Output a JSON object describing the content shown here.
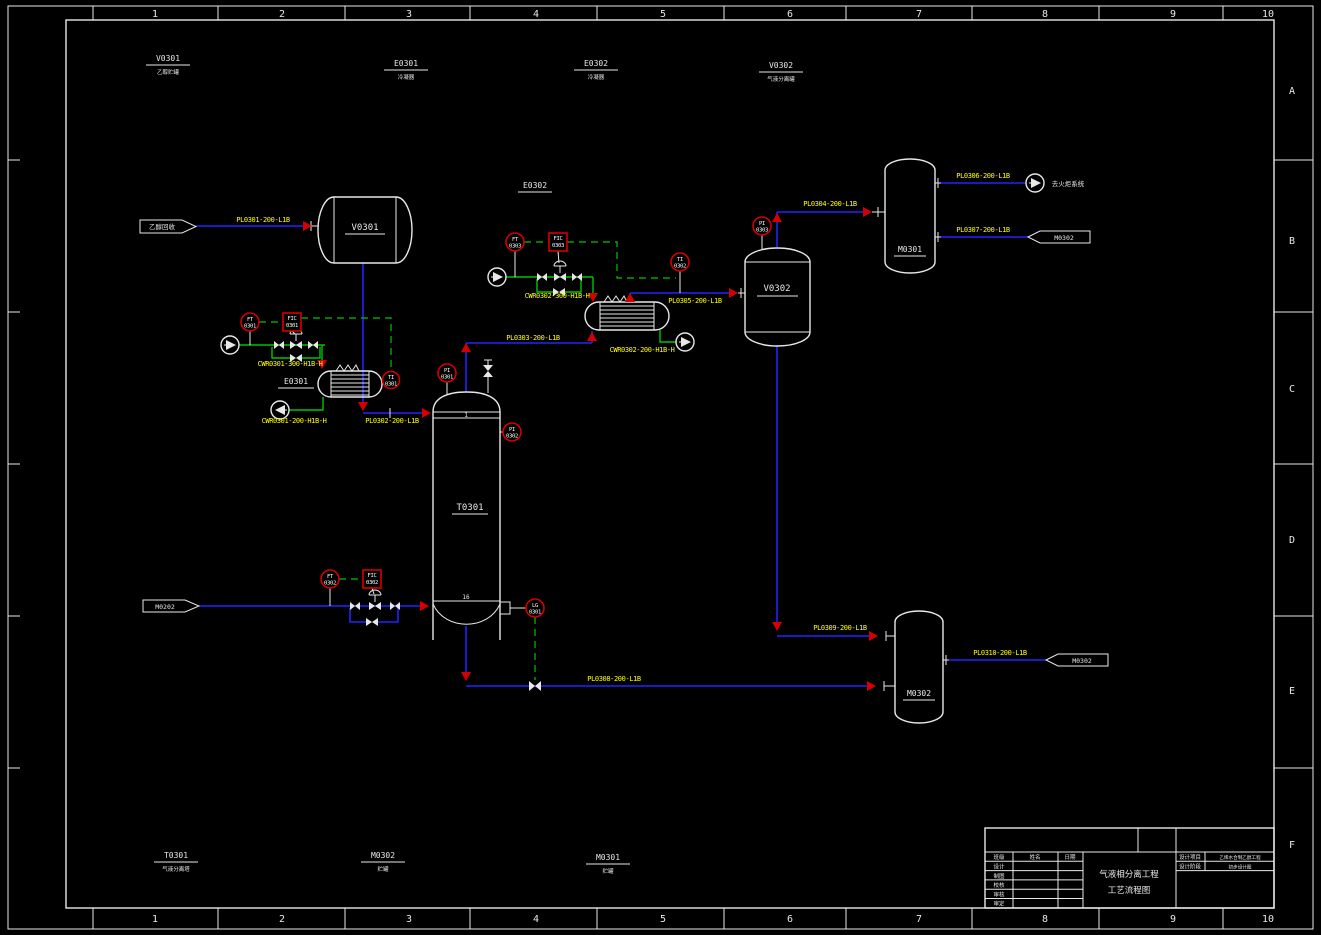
{
  "sheet": {
    "cols": [
      "1",
      "2",
      "3",
      "4",
      "5",
      "6",
      "7",
      "8",
      "9",
      "10"
    ],
    "rows": [
      "A",
      "B",
      "C",
      "D",
      "E",
      "F"
    ]
  },
  "colors": {
    "background": "#000000",
    "frame": "#e8e8e8",
    "process_line": "#2222ff",
    "utility_line": "#00c400",
    "pipe_label": "#ffff00",
    "instrument": "#d40000",
    "arrow": "#d40000"
  },
  "equipment": {
    "v0301": {
      "tag": "V0301",
      "name": "乙醇贮罐"
    },
    "e0301": {
      "tag": "E0301",
      "name": "冷凝器"
    },
    "e0302": {
      "tag": "E0302",
      "name": "冷凝器"
    },
    "v0302": {
      "tag": "V0302",
      "name": "气液分离罐"
    },
    "t0301": {
      "tag": "T0301",
      "name": "气液分离塔"
    },
    "m0301": {
      "tag": "M0301",
      "name": "贮罐"
    },
    "m0302": {
      "tag": "M0302",
      "name": "贮罐"
    }
  },
  "column": {
    "tray_top": "1",
    "tray_bottom": "16"
  },
  "connectors": {
    "feed_top": "乙醇回收",
    "feed_bottom": "M0202",
    "to_flare": "去火炬系统",
    "to_m0302_top": "M0302",
    "to_m0302_bottom": "M0302"
  },
  "pipes": {
    "pl0301": "PL0301-200-L1B",
    "pl0302": "PL0302-200-L1B",
    "pl0303": "PL0303-200-L1B",
    "pl0304": "PL0304-200-L1B",
    "pl0305": "PL0305-200-L1B",
    "pl0306": "PL0306-200-L1B",
    "pl0307": "PL0307-200-L1B",
    "pl0308": "PL0308-200-L1B",
    "pl0309": "PL0309-200-L1B",
    "pl0310": "PL0310-200-L1B",
    "cwr0301_supply": "CWR0301-300-H1B-H",
    "cwr0301_return": "CWR0301-200-H1B-H",
    "cwr0302_supply": "CWR0302-300-H1B-H",
    "cwr0302_return": "CWR0302-200-H1B-H"
  },
  "instruments": {
    "ft0301": {
      "line1": "FT",
      "line2": "0301"
    },
    "fic0301": {
      "line1": "FIC",
      "line2": "0301"
    },
    "ti0301": {
      "line1": "TI",
      "line2": "0301"
    },
    "ft0302": {
      "line1": "FT",
      "line2": "0302"
    },
    "fic0302": {
      "line1": "FIC",
      "line2": "0302"
    },
    "lg0301": {
      "line1": "LG",
      "line2": "0301"
    },
    "ft0303": {
      "line1": "FT",
      "line2": "0303"
    },
    "fic0303": {
      "line1": "FIC",
      "line2": "0303"
    },
    "ti0302": {
      "line1": "TI",
      "line2": "0302"
    },
    "pi0301": {
      "line1": "PI",
      "line2": "0301"
    },
    "pi0302": {
      "line1": "PI",
      "line2": "0302"
    },
    "pi0303": {
      "line1": "PI",
      "line2": "0303"
    }
  },
  "title_block": {
    "title_line1": "气液相分离工程",
    "title_line2": "工艺流程图",
    "col_headers": [
      "班级",
      "姓名",
      "日期"
    ],
    "rows": [
      "设计",
      "制图",
      "校核",
      "审核",
      "审定"
    ],
    "project_label": "设计项目",
    "project_value": "乙烯水合制乙醇工程",
    "stage_label": "设计阶段",
    "stage_value": "初步设计图"
  }
}
